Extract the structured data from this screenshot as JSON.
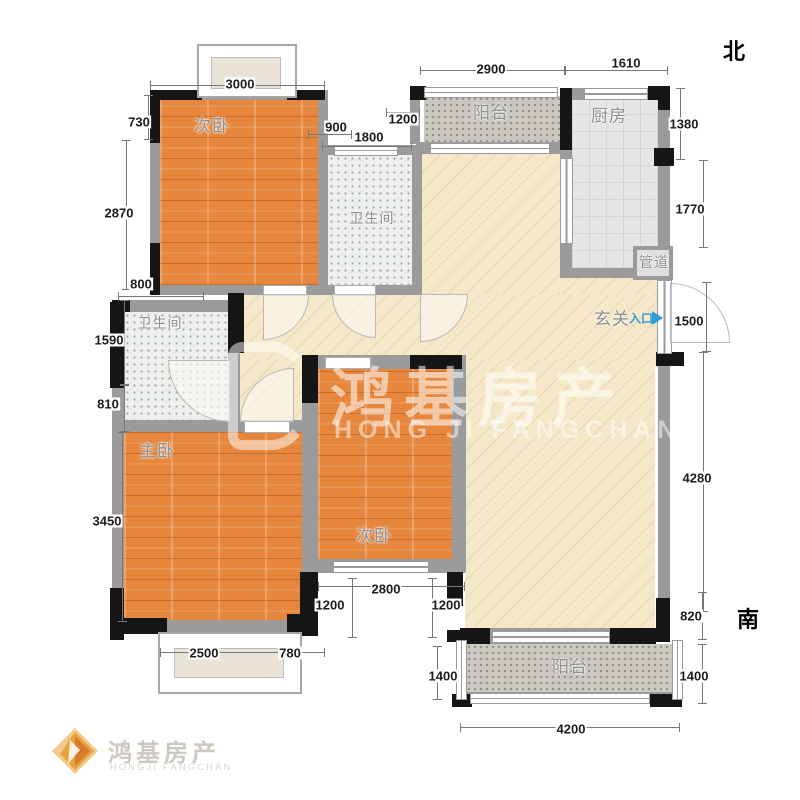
{
  "compass": {
    "north": "北",
    "south": "南"
  },
  "rooms": {
    "bedroom_top": {
      "label": "次卧"
    },
    "bathroom_top": {
      "label": "卫生间"
    },
    "balcony_top": {
      "label": "阳台"
    },
    "kitchen": {
      "label": "厨房"
    },
    "duct": {
      "label": "管道"
    },
    "entry": {
      "label": "玄关",
      "entrance": "入口"
    },
    "bathroom_left": {
      "label": "卫生间"
    },
    "master_bedroom": {
      "label": "主卧"
    },
    "bedroom_bottom": {
      "label": "次卧"
    },
    "balcony_bottom": {
      "label": "阳台"
    }
  },
  "dims": {
    "top": [
      "3000",
      "900",
      "1800",
      "1200",
      "2900",
      "1610"
    ],
    "left": [
      "730",
      "2870",
      "800",
      "1590",
      "810",
      "3450"
    ],
    "right": [
      "1380",
      "1770",
      "1500",
      "4280",
      "820"
    ],
    "bottom": [
      "2500",
      "780",
      "1200",
      "2800",
      "1200",
      "1400",
      "4200",
      "1400"
    ]
  },
  "watermark": {
    "center_cn": "鸿基房产",
    "center_en": "HONG JI FANGCHAN",
    "logo_cn": "鸿基房产",
    "logo_en": "HONGJI FANGCHAN"
  },
  "colors": {
    "wood": "#E6873D",
    "tile": "#EDEFED",
    "balcony": "#CBC8C2",
    "kitchen": "#E5E6E8",
    "living": "#F5E8C8",
    "wall": "#9B9B9B",
    "column": "#151515",
    "entrance_blue": "#2E9BD6",
    "logo_orange": "#E8A33D"
  }
}
